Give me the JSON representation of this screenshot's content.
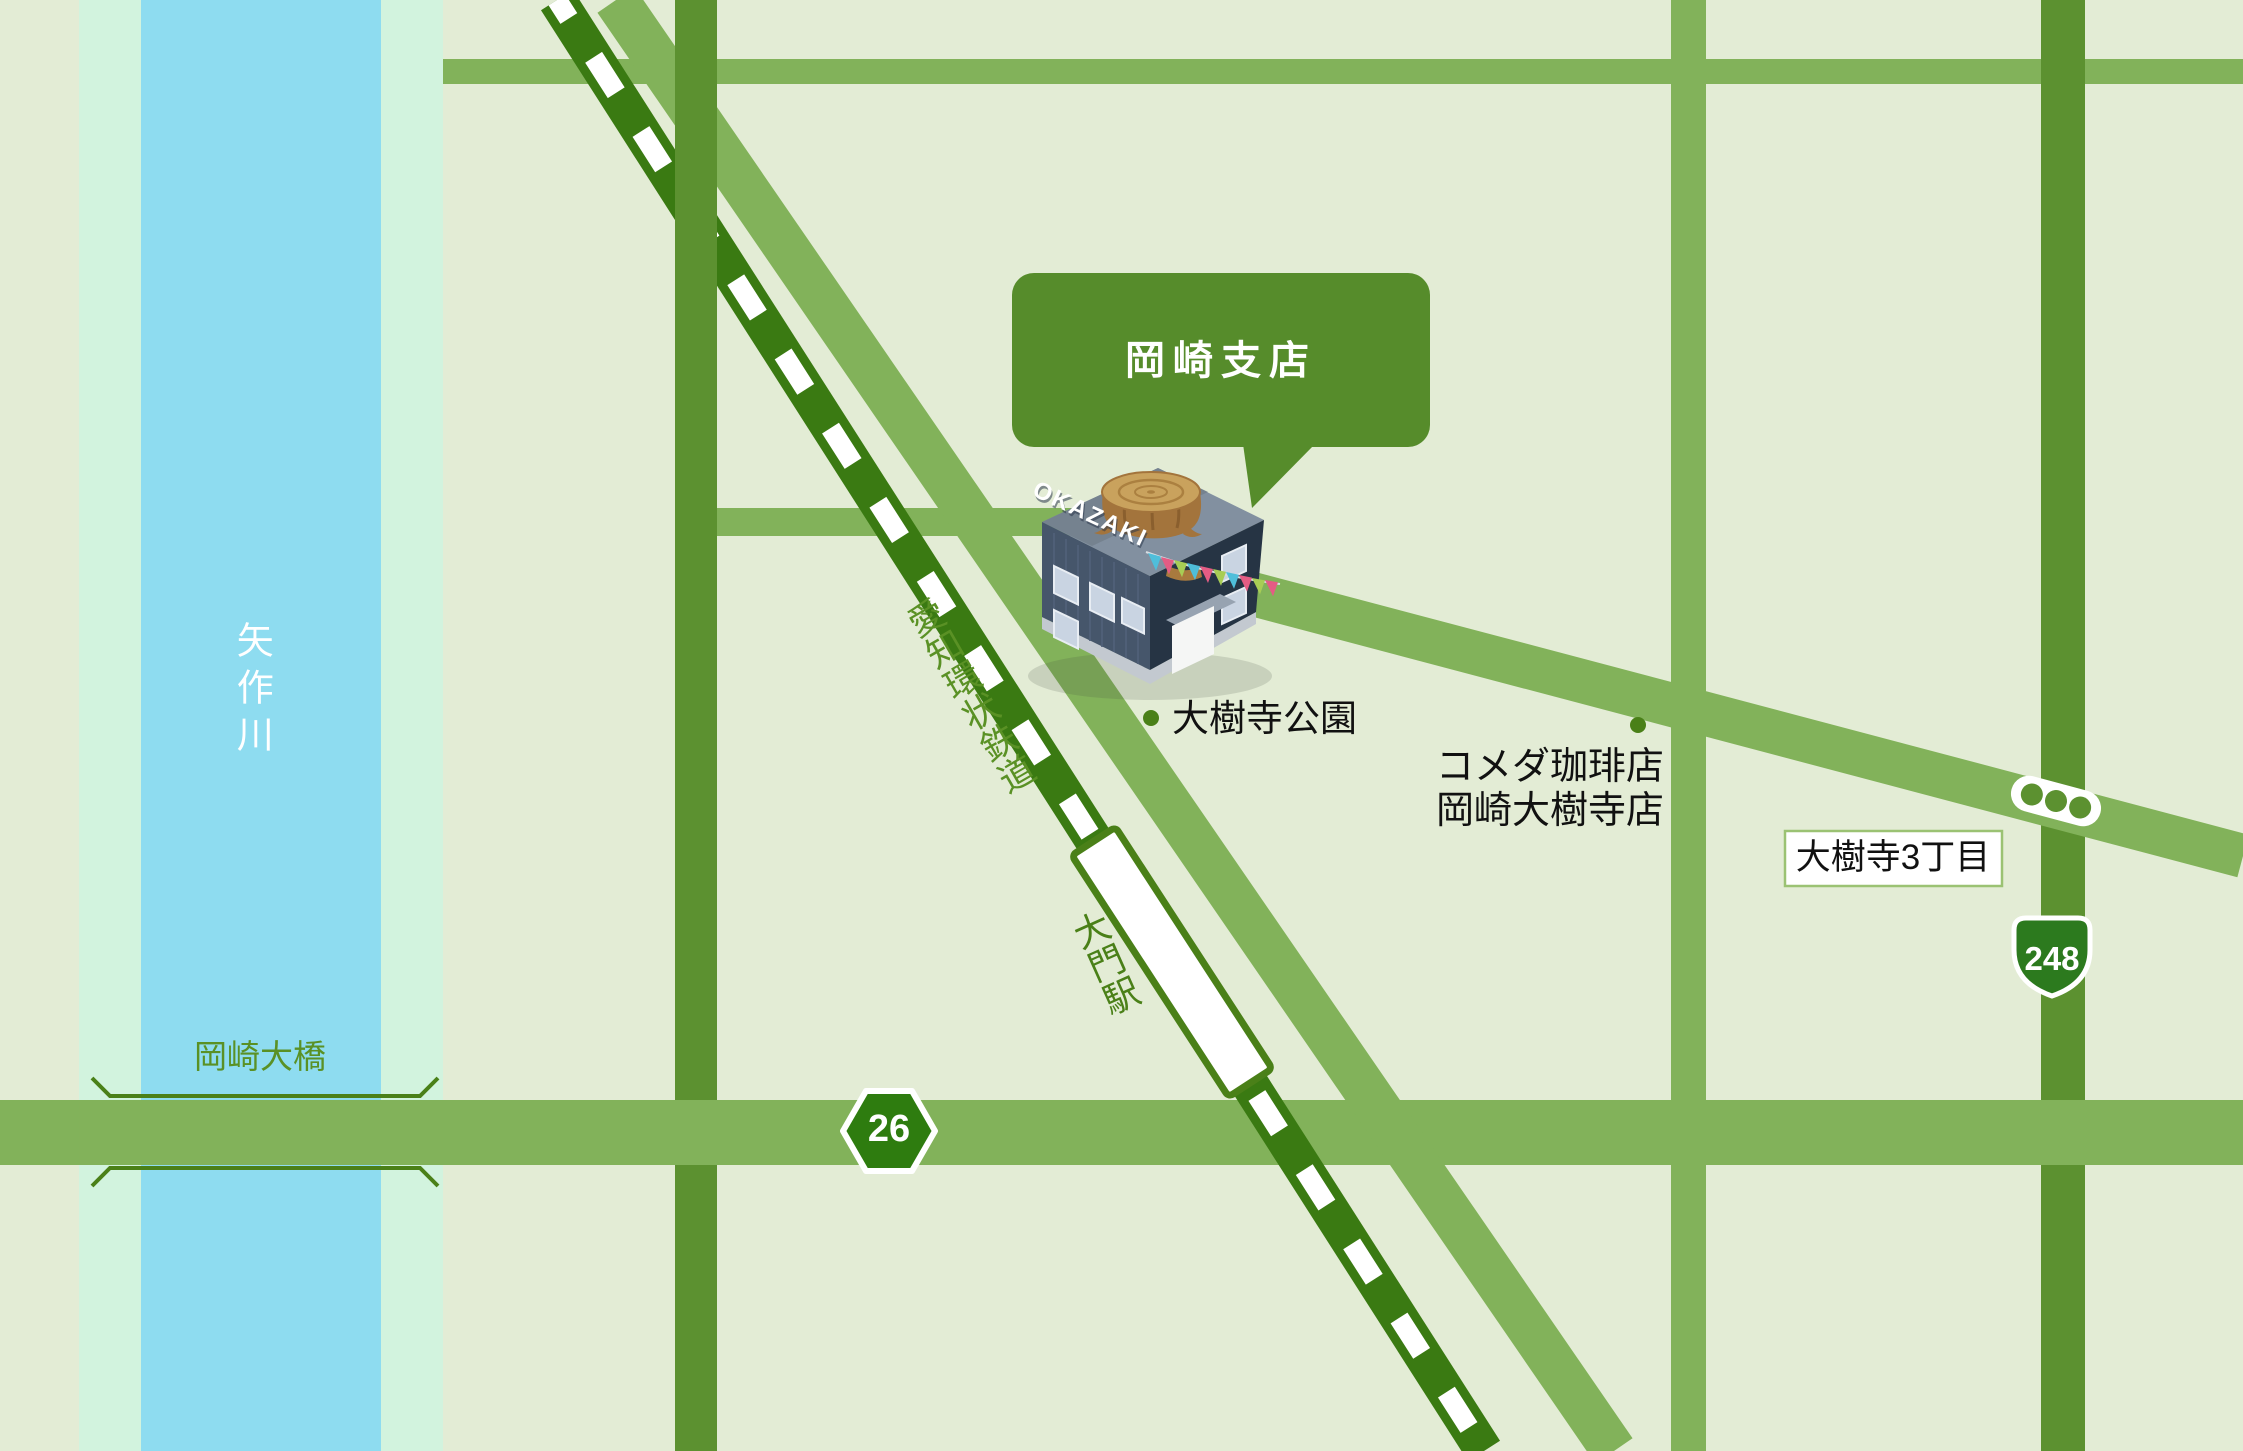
{
  "labels": {
    "branch": "岡崎支店",
    "building_sign": "OKAZAKI",
    "park": "大樹寺公園",
    "cafe_line1": "コメダ珈琲店",
    "cafe_line2": "岡崎大樹寺店",
    "district": "大樹寺3丁目",
    "river": "矢作川",
    "bridge": "岡崎大橋",
    "railway": "愛知環状鉄道",
    "station": "大門駅",
    "route26": "26",
    "route248": "248"
  },
  "colors": {
    "background": "#e3ecd5",
    "riverbank": "#d2f3de",
    "river": "#8edcf0",
    "road_medium": "#82b25a",
    "road_olive": "#5c9130",
    "railway": "#3a7a12",
    "railway_dash": "#ffffff",
    "station_outline": "#4a8018",
    "marker_dot": "#4a8018",
    "label_green": "#5a9125",
    "bubble": "#568c2b",
    "route_badge": "#2e7c0f",
    "route_shield": "#2c7a1e"
  }
}
